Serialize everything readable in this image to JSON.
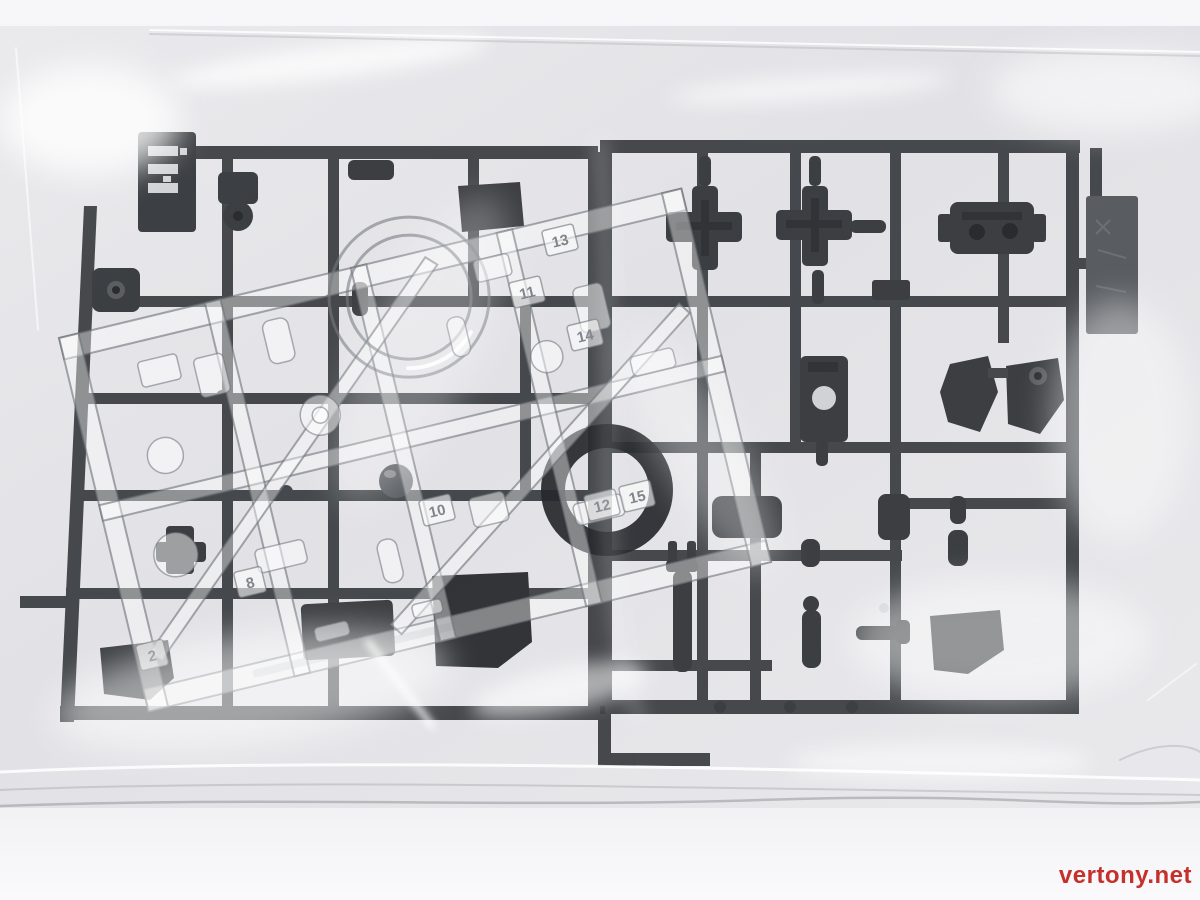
{
  "photo": {
    "subject": "Two dark gray plastic model-kit part runners and one clear runner sealed inside a glossy transparent plastic bag, photographed on a white surface",
    "watermark": {
      "text": "vertony.net",
      "color": "#c5302c"
    },
    "colors": {
      "background": "#f4f4f6",
      "bag": "#e6e6e9",
      "dark_plastic": "#35383c",
      "dark_plastic_dark": "#1f2124",
      "dark_plastic_light": "#4b4f54",
      "clear_edge": "#6a7077",
      "highlight": "#ffffff"
    },
    "part_tags": [
      {
        "label": "13"
      },
      {
        "label": "14"
      },
      {
        "label": "11"
      },
      {
        "label": "12"
      },
      {
        "label": "15"
      },
      {
        "label": "10"
      },
      {
        "label": "8"
      },
      {
        "label": "2"
      }
    ]
  }
}
